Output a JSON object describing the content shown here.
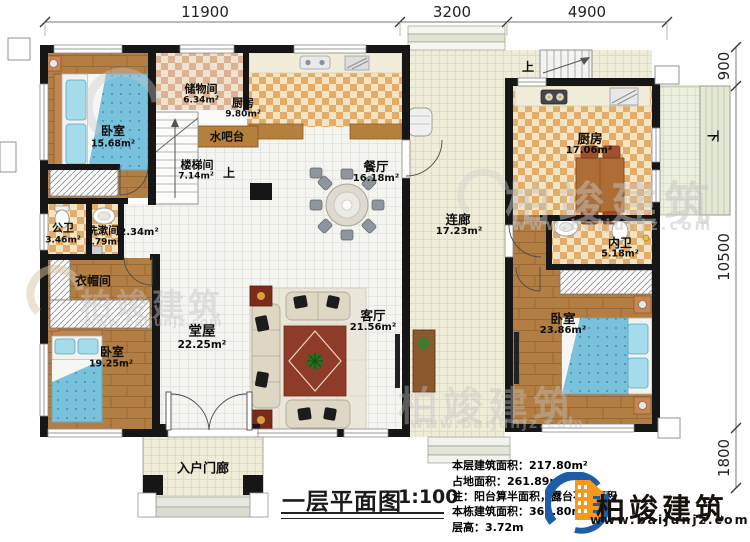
{
  "plan": {
    "title": "一层平面图",
    "scale": "1:100",
    "dimensions": {
      "top": [
        "11900",
        "3200",
        "4900"
      ],
      "right": [
        "900",
        "10500",
        "1800"
      ]
    },
    "stairs": {
      "up": "上",
      "down": "下"
    },
    "rooms": {
      "bedroom1": {
        "label": "卧室",
        "area": "15.68m²"
      },
      "storage": {
        "label": "储物间",
        "area": "6.34m²"
      },
      "kitchen1": {
        "label": "厨房",
        "area": "9.80m²"
      },
      "waterbar": {
        "label": "水吧台"
      },
      "stairwell": {
        "label": "楼梯间",
        "area": "7.14m²"
      },
      "publicbath": {
        "label": "公卫",
        "area": "3.46m²"
      },
      "washroom": {
        "label": "洗漱间",
        "area": "1.79m²"
      },
      "hallway": {
        "area": "2.34m²"
      },
      "cloakroom": {
        "label": "衣帽间"
      },
      "bedroom2": {
        "label": "卧室",
        "area": "19.25m²"
      },
      "mainhall": {
        "label": "堂屋",
        "area": "22.25m²"
      },
      "dining": {
        "label": "餐厅",
        "area": "16.18m²"
      },
      "living": {
        "label": "客厅",
        "area": "21.56m²"
      },
      "corridor": {
        "label": "连廊",
        "area": "17.23m²"
      },
      "kitchen2": {
        "label": "厨房",
        "area": "17.06m²"
      },
      "ensuite": {
        "label": "内卫",
        "area": "5.18m²"
      },
      "bedroom3": {
        "label": "卧室",
        "area": "23.86m²"
      },
      "porch": {
        "label": "入户门廊"
      }
    },
    "notes": {
      "line1": "本层建筑面积：217.80m²",
      "line2": "占地面积：261.89m²",
      "line3": "注：阳台算半面积，露台不算面积",
      "line4": "本栋建筑面积：362.80m²",
      "line5": "层高：3.72m"
    },
    "logo": {
      "brand": "柏竣建筑",
      "url": "www.baijunjz.com"
    },
    "watermark": {
      "brand": "柏竣建筑",
      "url": "www.baijunjz.com"
    },
    "colors": {
      "wall": "#161616",
      "wood_floor": "#b27e43",
      "tile_checker": "#e3ad69",
      "hall_tile": "#f4f4f1",
      "corridor_tile": "#efecd7",
      "bed_blue": "#79c2dc",
      "logo_orange": "#f5991d",
      "logo_blue": "#1e5ca8"
    }
  }
}
